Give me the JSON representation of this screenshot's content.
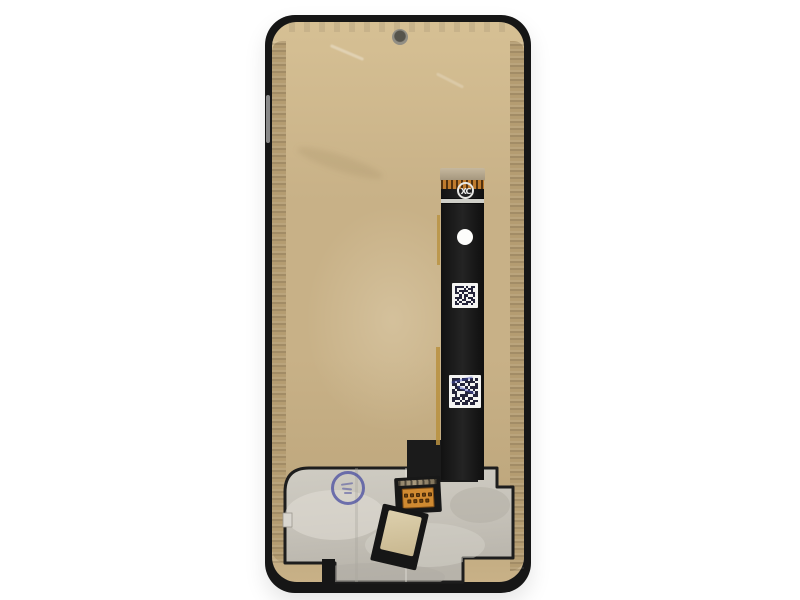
{
  "meta": {
    "scene": "Product photograph of a smartphone LCD display screen replacement assembly, rear view, centered on a plain white background",
    "orientation": "portrait"
  },
  "colors": {
    "bg": "#ffffff",
    "frame": "#161616",
    "film_hi": "#d6c094",
    "film": "#c8b187",
    "film_lo": "#bda67c",
    "seal": "#b49c71",
    "plate_edge": "#1d1d1d",
    "ribbon": "#1b1b1b",
    "gold_tip": "#b7a88d",
    "finger_orange": "#bf7b2d",
    "finger_dark": "#51310e",
    "conn_orange": "#d08a31",
    "conn_bronze": "#8f8168",
    "pin_dark": "#6f4210",
    "stamp_blue": "#4c509e",
    "qr_ink": "#24243a",
    "gold_line": "#b8913f",
    "white_part": "#f4f4f2"
  },
  "assembly": {
    "frame": {
      "label": "black mid-frame bezel"
    },
    "back_film": {
      "label": "tan protective backing film"
    },
    "camera_hole": {
      "label": "front camera aperture"
    },
    "seal_strips": {
      "label": "textured adhesive strips along inner left and right edges"
    },
    "shield_plate": {
      "label": "silver graphite shield plate at bottom",
      "white_tab": "small white pull tab on left edge",
      "notch": "black alignment notch at bottom left"
    },
    "qc_stamp": {
      "label": "round blue QC ink stamp"
    },
    "flex_cable": {
      "label": "main display flex cable ribbon",
      "logo_text": "XC",
      "tip": "gold stiffener tip",
      "contacts": "gold finger contacts",
      "punch_hole": "white alignment punch hole",
      "gold_trace": "gold edge trace beside ribbon",
      "qr_stickers": [
        {
          "label": "QR code sticker (upper)",
          "modules": [
            "111101011",
            "100010110",
            "101111010",
            "110100111",
            "001011001",
            "111010110",
            "010110011",
            "101001101",
            "110111010"
          ]
        },
        {
          "label": "QR code sticker (lower, with blue ink marks)",
          "modules": [
            "1110110101",
            "1010011110",
            "1101101001",
            "0110010111",
            "1011101010",
            "1100011101",
            "0101110011",
            "1110101100",
            "1001011011",
            "0110110110"
          ]
        }
      ],
      "connector": {
        "label": "board-to-board connector with gold pins",
        "pin_rows": [
          5,
          4
        ]
      },
      "pad": {
        "label": "square foam pad on lower flex"
      }
    }
  }
}
